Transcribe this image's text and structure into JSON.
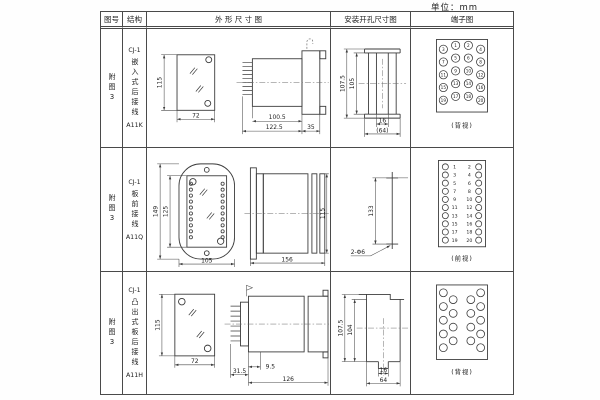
{
  "unit_label": "单位：mm",
  "header": {
    "fig": "图号",
    "structure": "结构",
    "outline": "外 形 尺 寸 图",
    "mounting": "安装开孔尺寸图",
    "terminal": "端子图"
  },
  "rows": [
    {
      "fig_no": "附图3",
      "structure": {
        "model": "CJ-1",
        "mount_type": "嵌入式后接线",
        "code": "A11K"
      },
      "outline": {
        "front_height": "115",
        "front_width": "72",
        "body_length": "100.5",
        "total_length": "122.5",
        "flange_depth": "35"
      },
      "mounting": {
        "outer_height": "107.5",
        "inner_height": "105",
        "slot_width": "16",
        "opening_width": "(64)"
      },
      "terminal": {
        "view_label": "(背视)",
        "numbers": [
          "1",
          "2",
          "3",
          "4",
          "5",
          "6",
          "7",
          "8",
          "9",
          "10",
          "11",
          "12",
          "13",
          "14",
          "15",
          "16",
          "17",
          "18",
          "19",
          "20"
        ]
      }
    },
    {
      "fig_no": "附图3",
      "structure": {
        "model": "CJ-1",
        "mount_type": "板前接线",
        "code": "A11Q"
      },
      "outline": {
        "front_height": "149",
        "window_height": "125",
        "front_width": "105",
        "side_length": "156",
        "side_height": "115"
      },
      "mounting": {
        "hole_distance": "133",
        "hole_note": "2-Φ6"
      },
      "terminal": {
        "view_label": "(前视)",
        "left_numbers": [
          "1",
          "3",
          "5",
          "7",
          "9",
          "11",
          "13",
          "15",
          "17",
          "19"
        ],
        "right_numbers": [
          "2",
          "4",
          "6",
          "8",
          "10",
          "12",
          "14",
          "16",
          "18",
          "20"
        ]
      }
    },
    {
      "fig_no": "附图3",
      "structure": {
        "model": "CJ-1",
        "mount_type": "凸出式板后接线",
        "code": "A11H"
      },
      "outline": {
        "front_height": "115",
        "front_width": "72",
        "pin_section": "31.5",
        "step": "9.5",
        "body_length": "126"
      },
      "mounting": {
        "outer_height": "107.5",
        "inner_height": "104",
        "slot_width": "16",
        "opening_width": "64"
      },
      "terminal": {
        "view_label": "(背视)"
      }
    }
  ]
}
